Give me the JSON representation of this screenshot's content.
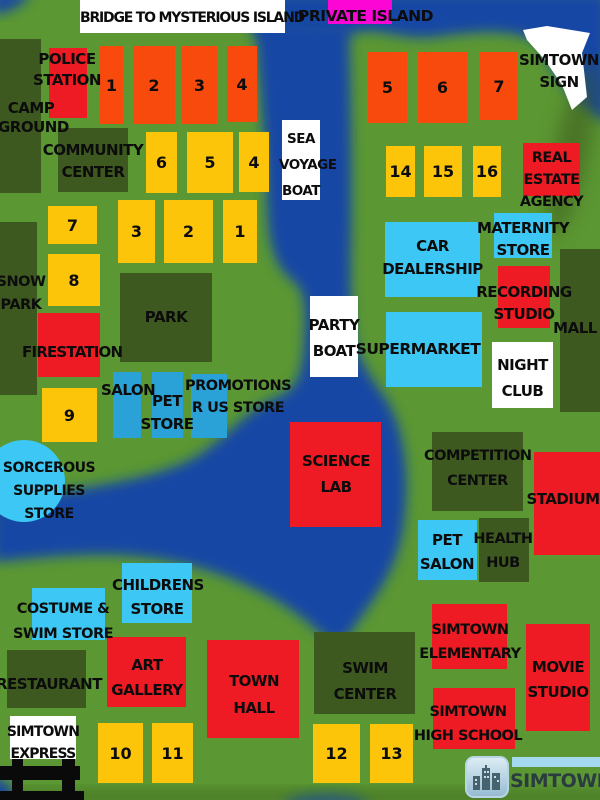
{
  "colors": {
    "grass": "#5b9733",
    "water": "#1446a5",
    "building_dark_green": "#3d591f",
    "building_red": "#ee1b24",
    "building_orange": "#f74a0c",
    "building_yellow": "#fcc50a",
    "building_cyan_light": "#3cc7f4",
    "building_cyan_dark": "#2aa2d8",
    "island_magenta": "#fb06d4",
    "sign_white": "#ffffff"
  },
  "banners": {
    "bridge": "BRIDGE TO MYSTERIOUS ISLAND",
    "private_island": "PRIVATE ISLAND",
    "simtown_sign": [
      "SIMTOWN",
      "SIGN"
    ],
    "sea_voyage_boat": [
      "SEA",
      "VOYAGE",
      "BOAT"
    ],
    "party_boat": [
      "PARTY",
      "BOAT"
    ],
    "night_club": [
      "NIGHT",
      "CLUB"
    ],
    "simtown_express": [
      "SIMTOWN",
      "EXPRESS"
    ]
  },
  "places": {
    "police_station": [
      "POLICE",
      "STATION"
    ],
    "camp_ground": [
      "CAMP",
      "GROUND"
    ],
    "community_center": [
      "COMMUNITY",
      "CENTER"
    ],
    "real_estate_agency": [
      "REAL",
      "ESTATE",
      "AGENCY"
    ],
    "snow_park": [
      "SNOW",
      "PARK"
    ],
    "firestation": "FIRESTATION",
    "park": "PARK",
    "car_dealership": [
      "CAR",
      "DEALERSHIP"
    ],
    "maternity_store": [
      "MATERNITY",
      "STORE"
    ],
    "recording_studio": [
      "RECORDING",
      "STUDIO"
    ],
    "mall": "MALL",
    "supermarket": "SUPERMARKET",
    "salon": "SALON",
    "pet_store": [
      "PET",
      "STORE"
    ],
    "promotions_r_us_store": [
      "PROMOTIONS",
      "R US STORE"
    ],
    "sorcerous_supplies_store": [
      "SORCEROUS",
      "SUPPLIES",
      "STORE"
    ],
    "science_lab": [
      "SCIENCE",
      "LAB"
    ],
    "competition_center": [
      "COMPETITION",
      "CENTER"
    ],
    "stadium": "STADIUM",
    "pet_salon": [
      "PET",
      "SALON"
    ],
    "health_hub": [
      "HEALTH",
      "HUB"
    ],
    "childrens_store": [
      "CHILDRENS",
      "STORE"
    ],
    "costume_swim_store": [
      "COSTUME &",
      "SWIM STORE"
    ],
    "restaurant": "RESTAURANT",
    "art_gallery": [
      "ART",
      "GALLERY"
    ],
    "town_hall": [
      "TOWN",
      "HALL"
    ],
    "swim_center": [
      "SWIM",
      "CENTER"
    ],
    "simtown_elementary": [
      "SIMTOWN",
      "ELEMENTARY"
    ],
    "simtown_high_school": [
      "SIMTOWN",
      "HIGH SCHOOL"
    ],
    "movie_studio": [
      "MOVIE",
      "STUDIO"
    ]
  },
  "lots": {
    "orange_left": [
      "1",
      "2",
      "3",
      "4"
    ],
    "orange_right": [
      "5",
      "6",
      "7"
    ],
    "yellow_row_upper": [
      "6",
      "5",
      "4"
    ],
    "yellow_row_lower": [
      "3",
      "2",
      "1"
    ],
    "yellow_singles": [
      "7",
      "8",
      "9"
    ],
    "yellow_row_right": [
      "14",
      "15",
      "16"
    ],
    "yellow_bottom_left": [
      "10",
      "11"
    ],
    "yellow_bottom_right": [
      "12",
      "13"
    ]
  },
  "logo": {
    "text": "SIMTOWN",
    "icon": "city-skyline-icon"
  }
}
